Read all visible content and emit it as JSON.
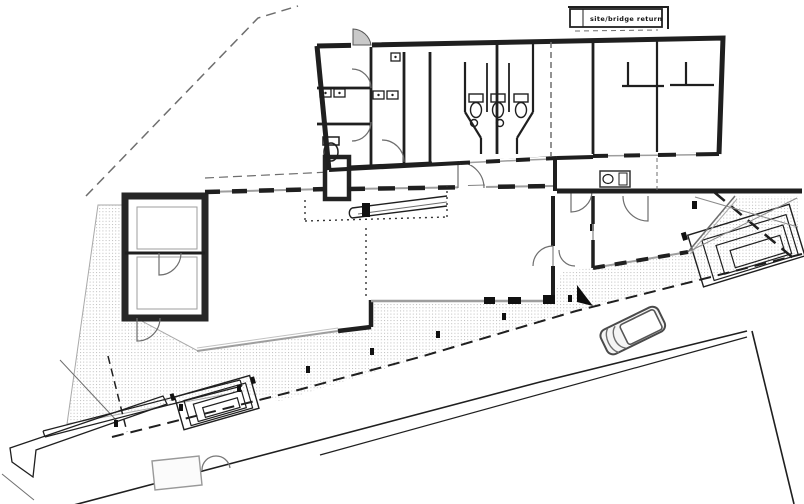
{
  "window": {
    "background": "#ffffff"
  },
  "plan": {
    "type": "architectural-site-plan",
    "title_box": {
      "label": "site/bridge return"
    },
    "colors": {
      "ink": "#1f1f1f",
      "medium_gray": "#6e6e6e",
      "light_gray": "#9e9e9e",
      "hatch_dot": "#bdbdbd",
      "paper": "#ffffff"
    },
    "cursor": {
      "shape": "arrow-pointer",
      "color": "#0d0d0d"
    }
  }
}
